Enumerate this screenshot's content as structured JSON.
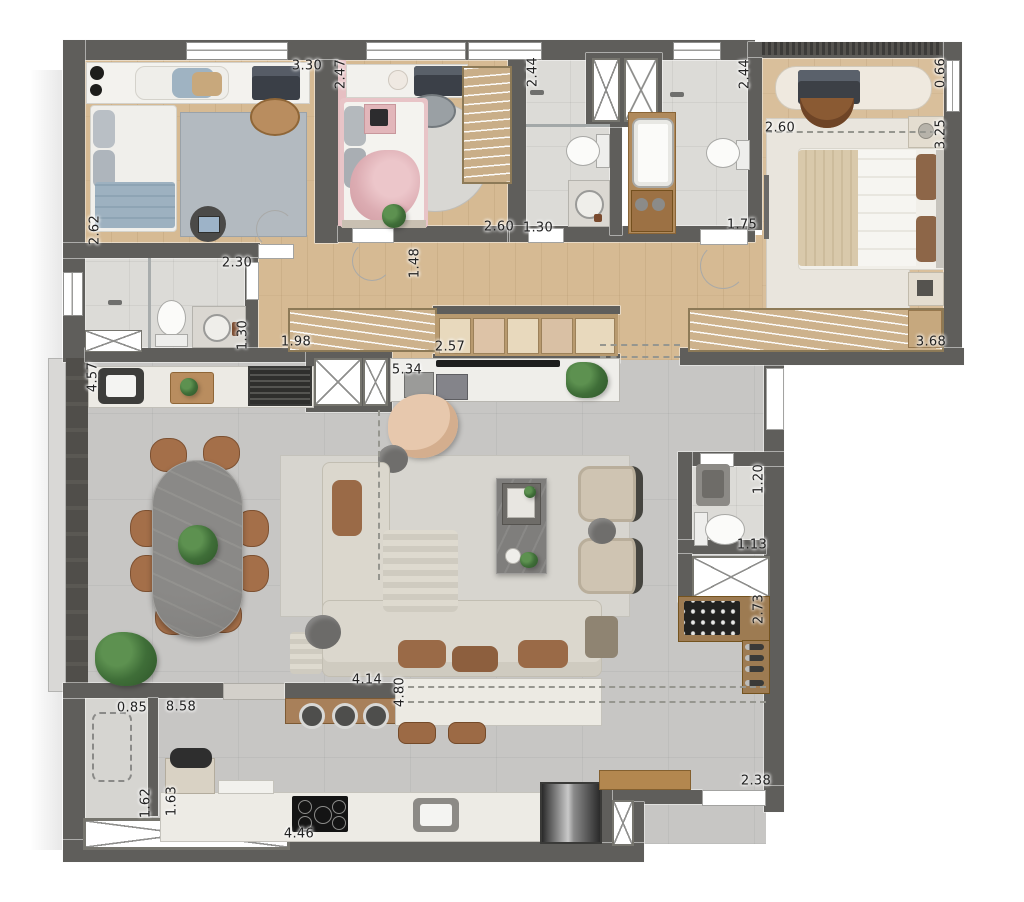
{
  "plan": {
    "type": "apartment-floor-plan",
    "units": "meters",
    "colors": {
      "wall": "#5f5e5b",
      "wood_floor": "#d6ba93",
      "tile_floor": "#dcdbd7",
      "living_floor": "#c7c6c4",
      "accent_pink": "#e6bfc2",
      "closet_wood": "#c9ae88",
      "furniture_wood": "#a8805a",
      "chair_brown": "#a46f49",
      "marble_dark": "#87868a",
      "plant_green": "#4a7c42",
      "dimension_text": "#222222",
      "background": "#ffffff"
    },
    "dimensions": [
      {
        "v": "3.30",
        "x": 307,
        "y": 66,
        "r": 0
      },
      {
        "v": "2.47",
        "x": 341,
        "y": 74,
        "r": 90
      },
      {
        "v": "2.44",
        "x": 533,
        "y": 72,
        "r": 90
      },
      {
        "v": "2.44",
        "x": 745,
        "y": 74,
        "r": 90
      },
      {
        "v": "0.66",
        "x": 941,
        "y": 73,
        "r": 90
      },
      {
        "v": "2.60",
        "x": 780,
        "y": 128,
        "r": 0
      },
      {
        "v": "3.25",
        "x": 941,
        "y": 134,
        "r": 90
      },
      {
        "v": "2.62",
        "x": 95,
        "y": 230,
        "r": 90
      },
      {
        "v": "2.60",
        "x": 499,
        "y": 227,
        "r": 0
      },
      {
        "v": "1.30",
        "x": 538,
        "y": 228,
        "r": 0
      },
      {
        "v": "1.75",
        "x": 742,
        "y": 225,
        "r": 0
      },
      {
        "v": "2.30",
        "x": 237,
        "y": 263,
        "r": 0
      },
      {
        "v": "1.48",
        "x": 415,
        "y": 263,
        "r": 90
      },
      {
        "v": "1.30",
        "x": 243,
        "y": 335,
        "r": 90
      },
      {
        "v": "1.98",
        "x": 296,
        "y": 342,
        "r": 0
      },
      {
        "v": "2.57",
        "x": 450,
        "y": 347,
        "r": 0
      },
      {
        "v": "3.68",
        "x": 931,
        "y": 342,
        "r": 0
      },
      {
        "v": "4.57",
        "x": 93,
        "y": 377,
        "r": 90
      },
      {
        "v": "5.34",
        "x": 407,
        "y": 370,
        "r": 0
      },
      {
        "v": "1.20",
        "x": 759,
        "y": 479,
        "r": 90
      },
      {
        "v": "1.13",
        "x": 752,
        "y": 545,
        "r": 0
      },
      {
        "v": "2.73",
        "x": 759,
        "y": 609,
        "r": 90
      },
      {
        "v": "0.85",
        "x": 132,
        "y": 708,
        "r": 0
      },
      {
        "v": "8.58",
        "x": 181,
        "y": 707,
        "r": 0
      },
      {
        "v": "4.14",
        "x": 367,
        "y": 680,
        "r": 0
      },
      {
        "v": "4.80",
        "x": 400,
        "y": 692,
        "r": 90
      },
      {
        "v": "1.62",
        "x": 146,
        "y": 803,
        "r": 90
      },
      {
        "v": "1.63",
        "x": 172,
        "y": 801,
        "r": 90
      },
      {
        "v": "4.46",
        "x": 299,
        "y": 834,
        "r": 0
      },
      {
        "v": "2.38",
        "x": 756,
        "y": 781,
        "r": 0
      }
    ]
  }
}
